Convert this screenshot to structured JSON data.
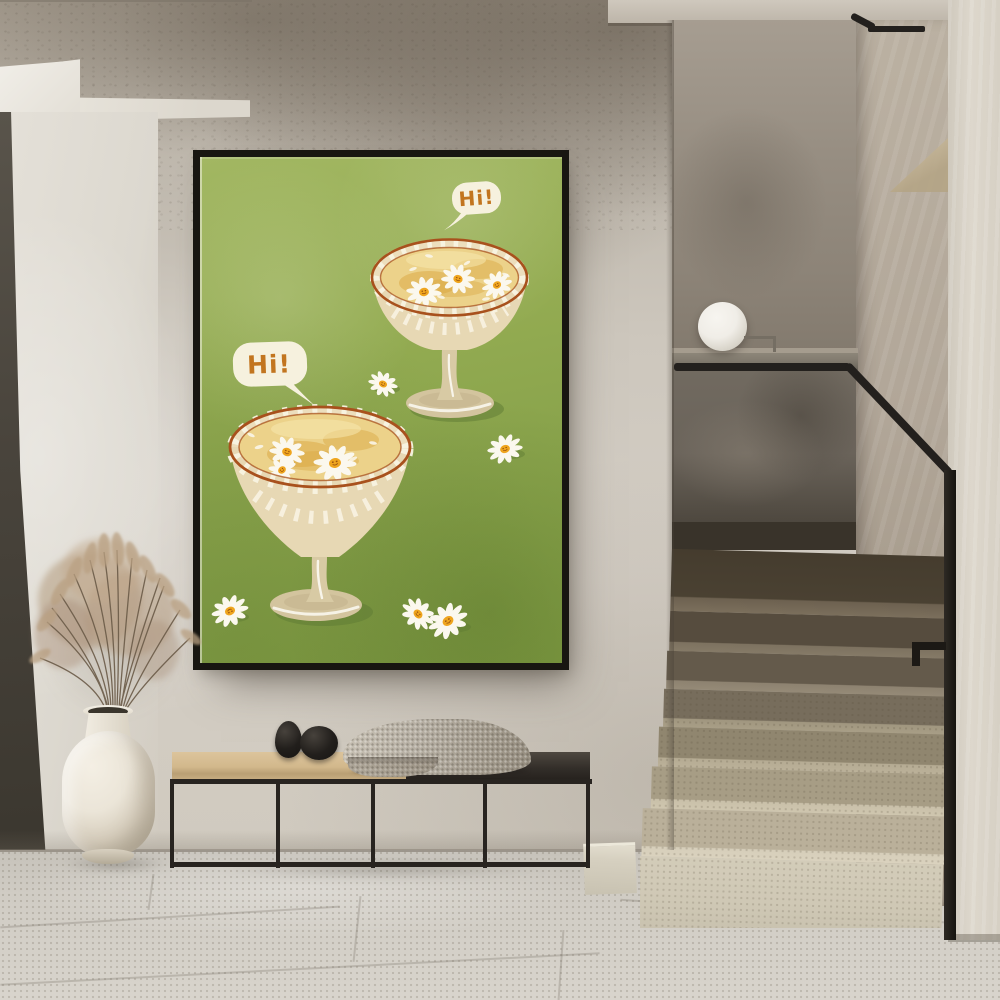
{
  "palette": {
    "wall_main": "#cdc7bd",
    "wall_top_shadow": "#948b7f",
    "wall_bright_panel": "#e4e0d8",
    "soffit_white": "#edeae2",
    "door_dark": "#49443c",
    "frame_black": "#181611",
    "art_green": "#94ac52",
    "art_green_deep": "#7e9a42",
    "bubble_cream": "#f6f1de",
    "text_orange": "#c2751f",
    "rim_orange": "#a8511d",
    "glass_cream": "#ecdebd",
    "stripe_white": "#f8f3e2",
    "liquid_gold": "#ecd28a",
    "liquid_deep": "#d9a63f",
    "daisy_petal": "#fbf8ee",
    "daisy_center": "#efa51e",
    "daisy_face": "#9a5310",
    "glass_tan": "#d3c49e",
    "shadow_green": "#5d7a33",
    "nook_wall": "#978e82",
    "balustrade_glass": "#6a635a",
    "ledge_gray": "#837c70",
    "rail_black": "#23201d",
    "sphere_white": "#f0ede7",
    "right_wall": "#b1a698",
    "far_wall": "#ddd7cc",
    "niche_beige": "#d5c6a7",
    "step_dark": "#4a4132",
    "step_mid": "#8d8270",
    "step_light": "#c9c0a9",
    "step_pale": "#d3ccb9",
    "floor_gray": "#d0ccc4",
    "bench_wood": "#d2b88c",
    "bench_dark_top": "#332e29",
    "bench_frame": "#282420",
    "blanket_gray": "#b6afa3",
    "stone_black": "#221f1c",
    "vase_cream": "#ebe5d8",
    "grass_plume": "#b39a7e",
    "grass_stem": "#6b5b48"
  },
  "artwork": {
    "bubbles": [
      {
        "text": "Hi!"
      },
      {
        "text": "Hi!"
      }
    ]
  },
  "scene": {
    "objects": [
      "framed-poster",
      "sphere-lamp",
      "staircase",
      "glass-balustrade",
      "handrail",
      "bench",
      "blanket",
      "decor-stones",
      "vase",
      "dried-grass",
      "tile-floor"
    ]
  }
}
